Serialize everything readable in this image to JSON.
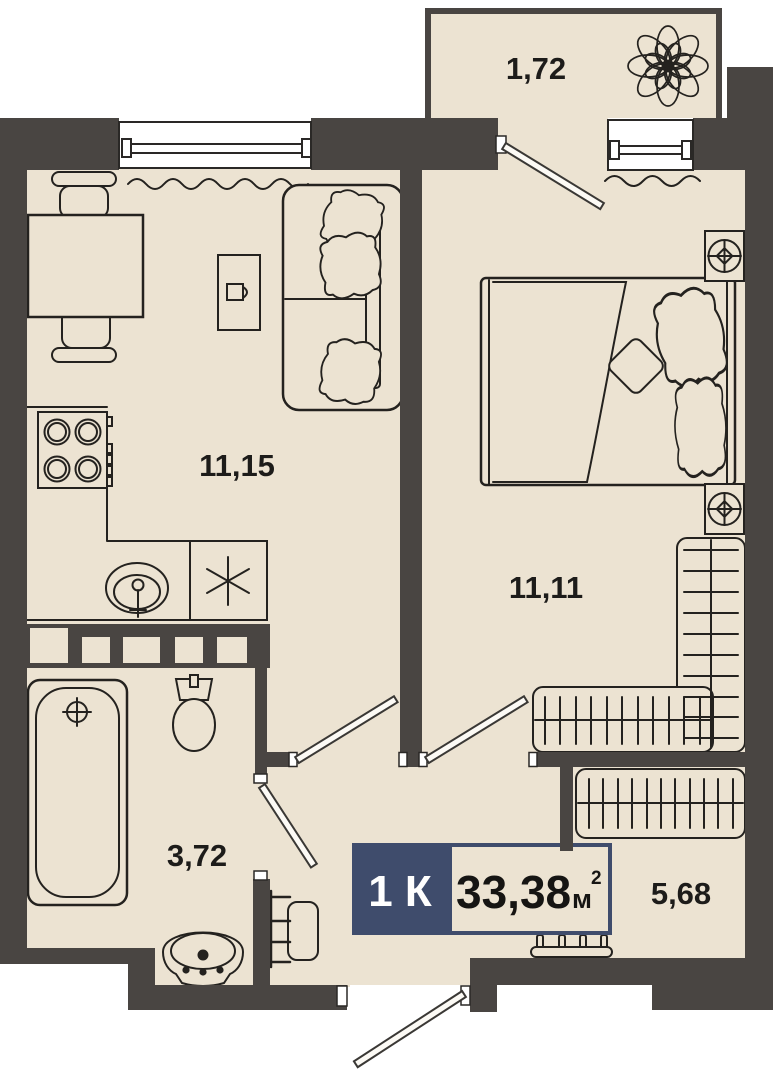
{
  "plan": {
    "title": "1-room apartment floor plan",
    "badge": {
      "type_label": "1 К",
      "area_value": "33,38",
      "area_unit": "м",
      "area_sup": "2"
    },
    "rooms": [
      {
        "id": "kitchen-living",
        "label": "11,15"
      },
      {
        "id": "bedroom",
        "label": "11,11"
      },
      {
        "id": "bathroom",
        "label": "3,72"
      },
      {
        "id": "hallway",
        "label": "5,68"
      },
      {
        "id": "balcony",
        "label": "1,72"
      }
    ],
    "symbols": [
      "stove",
      "sink",
      "refrigerator",
      "dining-table",
      "chair",
      "sofa",
      "coffee-table",
      "bed",
      "nightstand-lamp",
      "wardrobe",
      "bathtub",
      "toilet",
      "washbasin",
      "towel-rail",
      "radiator",
      "window",
      "door",
      "flower"
    ],
    "colors": {
      "wall": "#494542",
      "floor": "#ece3d2",
      "accent": "#3f4c6c",
      "line": "#24221f",
      "window": "#ffffff",
      "background": "#ffffff"
    }
  }
}
